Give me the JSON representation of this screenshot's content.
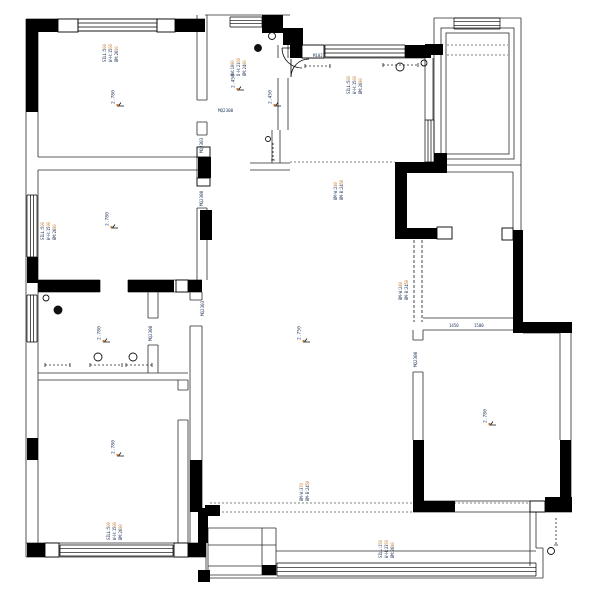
{
  "drawing": {
    "type": "residential-floor-plan",
    "colors": {
      "wall": "#000000",
      "line": "#2b2b2b",
      "dotted": "#555555",
      "annotation": "#23365e",
      "accent": "#c67a2e",
      "background": "#ffffff"
    },
    "elevation_markers": [
      {
        "id": "room-top-left",
        "x": 117,
        "y": 106,
        "value": "2.780"
      },
      {
        "id": "foyer-a",
        "x": 237,
        "y": 90,
        "value": "2.450"
      },
      {
        "id": "foyer-b",
        "x": 274,
        "y": 106,
        "value": "2.450"
      },
      {
        "id": "room-mid-left",
        "x": 111,
        "y": 228,
        "value": "2.780"
      },
      {
        "id": "room-small-left",
        "x": 103,
        "y": 342,
        "value": "2.780"
      },
      {
        "id": "room-bottom-left",
        "x": 117,
        "y": 456,
        "value": "2.780"
      },
      {
        "id": "living-room",
        "x": 303,
        "y": 342,
        "value": "2.750"
      },
      {
        "id": "room-right",
        "x": 489,
        "y": 425,
        "value": "2.780"
      }
    ],
    "opening_tags": [
      {
        "id": "hall-opening",
        "x": 218,
        "y": 112,
        "text": "MQ2300",
        "rot": 0
      },
      {
        "id": "hall-door-upper",
        "x": 203,
        "y": 153,
        "text": "MQ2303",
        "rot": -90
      },
      {
        "id": "hall-door-lower",
        "x": 203,
        "y": 206,
        "text": "MQ2300",
        "rot": -90
      },
      {
        "id": "corridor-door",
        "x": 204,
        "y": 316,
        "text": "MQ2303",
        "rot": -90
      },
      {
        "id": "study-door",
        "x": 152,
        "y": 341,
        "text": "MQ2300",
        "rot": -90
      },
      {
        "id": "bedroom-right-door",
        "x": 417,
        "y": 367,
        "text": "MQ2300",
        "rot": -90
      }
    ],
    "small_tags": [
      {
        "id": "entry-door-tag",
        "x": 313,
        "y": 57,
        "text": "M1021"
      },
      {
        "id": "dim-tag-1",
        "x": 449,
        "y": 327,
        "text": "1450"
      },
      {
        "id": "dim-tag-2",
        "x": 474,
        "y": 327,
        "text": "1500"
      }
    ],
    "annotation_stacks": [
      {
        "id": "window-top-left",
        "x": 106,
        "y": 62,
        "lines": [
          "SILL:500",
          "W-H:1500",
          "BM:2600"
        ]
      },
      {
        "id": "entry-note",
        "x": 234,
        "y": 76,
        "lines": [
          "DW:1000",
          "D-H:2100",
          "BM:2400"
        ]
      },
      {
        "id": "window-top-right",
        "x": 350,
        "y": 94,
        "lines": [
          "SILL:500",
          "W-H:1500",
          "BM:2600"
        ]
      },
      {
        "id": "window-mid-left",
        "x": 44,
        "y": 240,
        "lines": [
          "SILL:500",
          "W-H:1500",
          "BM:2600"
        ]
      },
      {
        "id": "beam-living-top",
        "x": 337,
        "y": 200,
        "lines": [
          "BM-W:240",
          "BM-B:2450"
        ]
      },
      {
        "id": "beam-duct",
        "x": 402,
        "y": 300,
        "lines": [
          "BM-W:240",
          "BM-B:2450"
        ]
      },
      {
        "id": "beam-living-bottom",
        "x": 303,
        "y": 501,
        "lines": [
          "BM-W:370",
          "BM-B:2450"
        ]
      },
      {
        "id": "window-bottom-left",
        "x": 110,
        "y": 540,
        "lines": [
          "SILL:500",
          "W-H:1500",
          "BM:2600"
        ]
      },
      {
        "id": "window-balcony",
        "x": 382,
        "y": 558,
        "lines": [
          "SILL:150",
          "W-H:2350",
          "BM:2600"
        ]
      }
    ],
    "lights": [
      {
        "id": "foyer-downlight",
        "x": 272,
        "y": 36,
        "r": 3.5,
        "filled": false
      },
      {
        "id": "foyer-lamp",
        "x": 258,
        "y": 48,
        "r": 3.5,
        "filled": true
      },
      {
        "id": "hall-downlight",
        "x": 268,
        "y": 139,
        "r": 2.5,
        "filled": false
      },
      {
        "id": "dining-downlight-1",
        "x": 400,
        "y": 67,
        "r": 4,
        "filled": false
      },
      {
        "id": "dining-downlight-2",
        "x": 424,
        "y": 63,
        "r": 3,
        "filled": false
      },
      {
        "id": "study-downlight",
        "x": 46,
        "y": 298,
        "r": 3,
        "filled": false
      },
      {
        "id": "study-lamp",
        "x": 58,
        "y": 310,
        "r": 4,
        "filled": true
      },
      {
        "id": "study-downlight-2",
        "x": 98,
        "y": 357,
        "r": 4,
        "filled": false
      },
      {
        "id": "study-downlight-3",
        "x": 133,
        "y": 357,
        "r": 4,
        "filled": false
      },
      {
        "id": "balcony-downlight",
        "x": 551,
        "y": 551,
        "r": 3.5,
        "filled": false
      }
    ]
  }
}
